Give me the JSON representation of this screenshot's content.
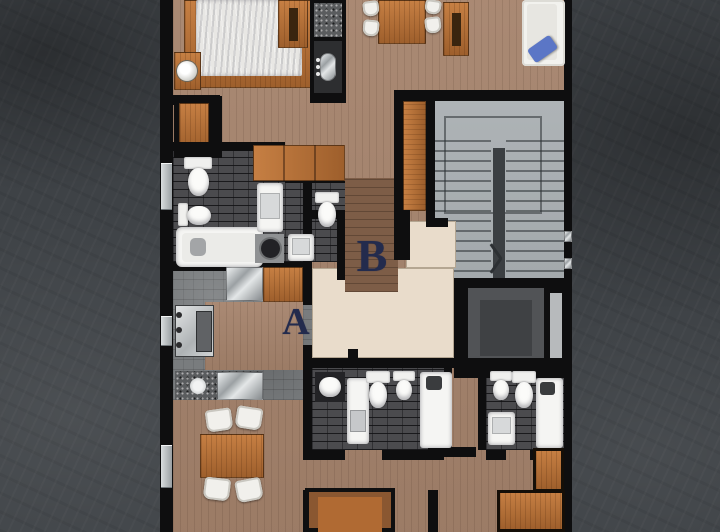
{
  "scene": {
    "kind": "residential-floor-plan",
    "units": [
      {
        "label": "A"
      },
      {
        "label": "B"
      }
    ],
    "palette": {
      "background_concrete": "#3e4246",
      "wall_black": "#0e0e0f",
      "wood_floor": "#a5836c",
      "wood_dark_floor": "#7d5d47",
      "furniture_wood": "#b06a33",
      "dark_tile": "#4b4b4e",
      "kitchen_tile": "#797c7e",
      "stair_gray": "#a9aeb1",
      "landing_beige": "#e9dccb",
      "elevator_gray": "#515356",
      "fixture_white": "#f5f5f3",
      "cushion_blue": "#5b76c6",
      "label_navy": "#232b4d"
    },
    "fixtures": [
      "bed",
      "nightstand",
      "lamp",
      "closet",
      "wardrobe",
      "kitchen-island",
      "sink",
      "basin",
      "stove",
      "counter",
      "dining-table",
      "chair",
      "armchair",
      "sofa",
      "cushion",
      "toilet",
      "bidet",
      "bathtub",
      "shower",
      "vanity",
      "washer",
      "stairs",
      "elevator",
      "window"
    ]
  }
}
